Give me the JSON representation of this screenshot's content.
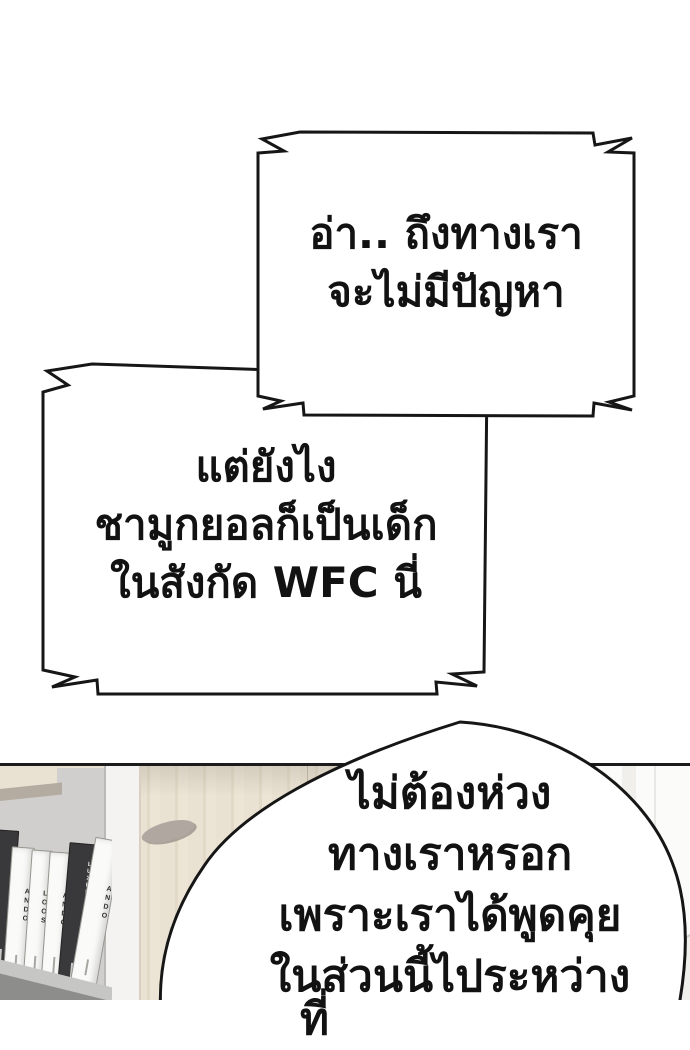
{
  "bubble1": {
    "lines": [
      "อ่า.. ถึงทางเรา",
      "จะไม่มีปัญหา"
    ]
  },
  "bubble2": {
    "lines": [
      "แต่ยังไง",
      "ชามูกยอลก็เป็นเด็ก",
      "ในสังกัด WFC นี่"
    ]
  },
  "bubble3": {
    "lines": [
      "ไม่ต้องห่วง",
      "ทางเราหรอก",
      "เพราะเราได้พูดคุย",
      "ในส่วนนี้ไประหว่าง"
    ],
    "partial_line": "ที่"
  },
  "scene": {
    "books": [
      {
        "title": "LUXURY H",
        "style": "dark"
      },
      {
        "title": "ANDO",
        "style": "light"
      },
      {
        "title": "LOOS",
        "style": "light"
      },
      {
        "title": "ANDO",
        "style": "light"
      },
      {
        "title": "LUXURY HOUSES",
        "style": "dark"
      },
      {
        "title": "ANDO",
        "style": "light"
      }
    ]
  },
  "colors": {
    "outline": "#161616",
    "background": "#ffffff",
    "cabinet_wood": "#e8e1d2",
    "alcove_gray": "#d0cfcd",
    "dark_spine": "#39393c"
  }
}
